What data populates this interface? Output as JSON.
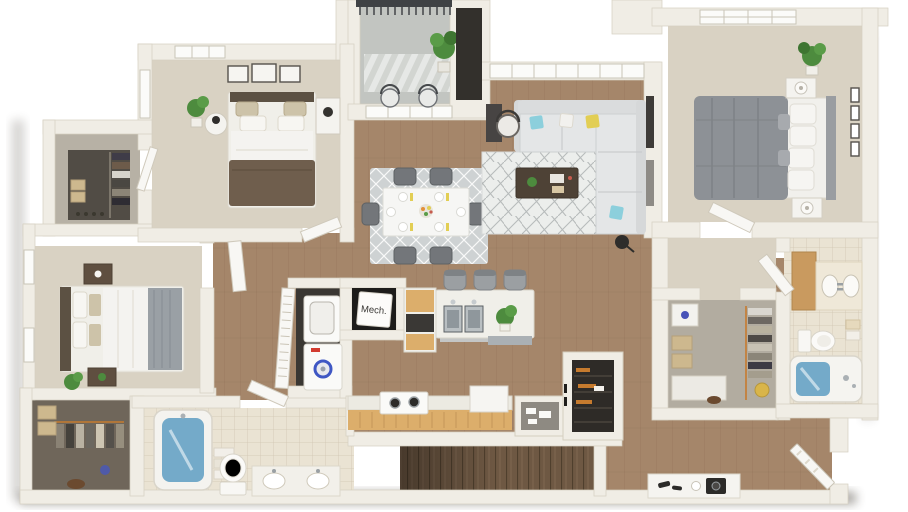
{
  "scene": {
    "description": "3D rendered top-down floor plan of a three-bedroom two-bath apartment with balcony",
    "background": "#ffffff"
  },
  "labels": {
    "mech_closet": "Mech."
  },
  "rooms": [
    "balcony",
    "bedroom-2",
    "walk-in-closet-2",
    "bedroom-3",
    "walk-in-closet-3",
    "bathroom-2",
    "hallway",
    "laundry-closet",
    "mechanical-closet",
    "kitchen",
    "dining-area",
    "living-room",
    "master-bedroom",
    "master-closet",
    "master-bathroom",
    "entry",
    "stairs"
  ],
  "colors": {
    "wall": "#f0ede5",
    "wall_edge": "#d5cfc0",
    "wood_floor": "#a5866a",
    "wood_dark": "#8d7156",
    "carpet": "#d9d2c3",
    "tile": "#eae3d3",
    "closet_dark": "#514c45",
    "closet3_floor": "#6f665a",
    "master_closet_floor": "#b2aca0",
    "balcony_floor": "#c2c5c1",
    "stair_wood": "#6e5843",
    "sofa": "#e4e6e7",
    "rug_dining": "#ced2d3",
    "rug_living": "#eceeec",
    "table_white": "#f6f6f4",
    "chair_gray": "#73767a",
    "bed_brown": "#6f5e4d",
    "bed_gray": "#8d9196",
    "headboard_dark": "#5c5143",
    "pillow_blue": "#8ccfdc",
    "pillow_yellow": "#e2ce54",
    "plant_green": "#4d8b3e",
    "tub_water": "#74aac9",
    "counter_wood": "#dcae6b",
    "island_white": "#f0efe9",
    "steel": "#aab0b4",
    "appliance_white": "#fafaf8",
    "washer_logo_red": "#d23b2f",
    "washer_dial_blue": "#3f57c4",
    "door_white": "#f8f7f4",
    "railing_dark": "#3f4245",
    "coffee_table": "#4e4236",
    "gold": "#d9b54a"
  }
}
